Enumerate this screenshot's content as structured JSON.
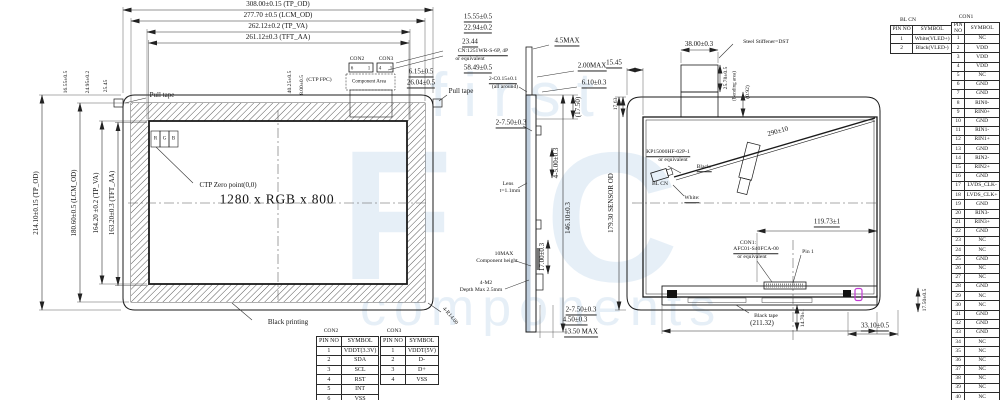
{
  "watermark": {
    "word_top": "first",
    "letter_f": "F",
    "letter_c": "C",
    "word_bottom": "components"
  },
  "front": {
    "top_dims": [
      "308.00±0.15 (TP_OD)",
      "277.70 ±0.5 (LCM_OD)",
      "262.12±0.2 (TP_VA)",
      "261.12±0.3 (TFT_AA)"
    ],
    "left_dims": [
      "214.10±0.15 (TP_OD)",
      "180.60±0.5 (LCM_OD)",
      "164.20 ±0.2 (TP_VA)",
      "163.20±0.3 (TFT_AA)"
    ],
    "left_top_dims": [
      "16.55±0.5",
      "24.95±0.2",
      "25.45"
    ],
    "right_dims": [
      "15.55±0.5",
      "22.94±0.2",
      "23.44",
      "58.49±0.5"
    ],
    "cn_note": [
      "CN:1251WR-S-6P, 4P",
      "or equivalent"
    ],
    "con2_label": "CON2",
    "con3_label": "CON3",
    "ctp_fpc": "(CTP FPC)",
    "component_area": "Component Area",
    "con_dims": [
      "6.15±0.5",
      "26.04±0.5",
      "40.25±0.5",
      "8.00±0.5"
    ],
    "pin_marks": [
      "6",
      "1",
      "4",
      "1"
    ],
    "pull_tape_left": "Pull tape",
    "pull_tape_right": "Pull tape",
    "rgb": [
      "R",
      "G",
      "B"
    ],
    "ctp_zero": "CTP Zero point(0,0)",
    "resolution": "1280 x RGB x 800",
    "black_printing": "Black printing",
    "corner_radius": "4-R14.00"
  },
  "side": {
    "dims": {
      "max45": "4.5MAX",
      "max200": "2.00MAX",
      "chamfer": "2-C0.15±0.1",
      "chamfer2": "(all around)",
      "d610": "6.10±0.3",
      "d1750": "(17.50)",
      "top750": "2-7.50±0.3",
      "d500": "4-5.00±0.3",
      "h146": "146.10±0.3",
      "d1700": "17.00±0.3",
      "bot750": "2-7.50±0.3",
      "d450": "4.50±0.3",
      "max1350": "13.50 MAX"
    },
    "lens": [
      "Lens",
      "t=1.1mm"
    ],
    "component": [
      "10MAX",
      "Component height"
    ],
    "screw": [
      "4-M2",
      "Depth Max 2.5mm"
    ]
  },
  "back": {
    "dims": {
      "d3800": "38.00±0.3",
      "d2578": "25.78±0.5",
      "bending": "(Bending area)",
      "d092": "(0.92)",
      "d1545": "15.45",
      "d1763": "17.63",
      "d290": "290±10",
      "d11973": "119.73±1",
      "d21132": "(211.32)",
      "d1470": "14.70±1",
      "d3310": "33.10±0.5",
      "d1750": "17.50±0.5",
      "sensor_od": "179.30 SENSOR OD"
    },
    "stiffener": "Steel Stiffener=DST",
    "bl_part": [
      "KP15000HF-02P-1",
      "or equivalent"
    ],
    "wire_black": "Black:",
    "wire_white": "White:",
    "bl_cn": "BL CN",
    "con1_note": [
      "CON1:",
      "AFC01-S40FCA-00",
      "or equivalent"
    ],
    "pin1": "Pin 1",
    "black_tape": "Black tape"
  },
  "tables": {
    "con2": {
      "title": "CON2",
      "headers": [
        "PIN NO",
        "SYMBOL"
      ],
      "rows": [
        [
          "1",
          "VDDT(3.3V)"
        ],
        [
          "2",
          "SDA"
        ],
        [
          "3",
          "SCL"
        ],
        [
          "4",
          "RST"
        ],
        [
          "5",
          "INT"
        ],
        [
          "6",
          "VSS"
        ]
      ]
    },
    "con3": {
      "title": "CON3",
      "headers": [
        "PIN NO",
        "SYMBOL"
      ],
      "rows": [
        [
          "1",
          "VDDT(5V)"
        ],
        [
          "2",
          "D-"
        ],
        [
          "3",
          "D+"
        ],
        [
          "4",
          "VSS"
        ]
      ]
    },
    "bl_cn": {
      "title": "BL CN",
      "headers": [
        "PIN NO",
        "SYMBOL"
      ],
      "rows": [
        [
          "1",
          "White(VLED+)"
        ],
        [
          "2",
          "Black(VLED-)"
        ]
      ]
    },
    "con1": {
      "title": "CON1",
      "headers": [
        "PIN NO",
        "SYMBOL"
      ],
      "rows": [
        [
          "1",
          "NC"
        ],
        [
          "2",
          "VDD"
        ],
        [
          "3",
          "VDD"
        ],
        [
          "4",
          "VDD"
        ],
        [
          "5",
          "NC"
        ],
        [
          "6",
          "GND"
        ],
        [
          "7",
          "GND"
        ],
        [
          "8",
          "RIN0-"
        ],
        [
          "9",
          "RIN0+"
        ],
        [
          "10",
          "GND"
        ],
        [
          "11",
          "RIN1-"
        ],
        [
          "12",
          "RIN1+"
        ],
        [
          "13",
          "GND"
        ],
        [
          "14",
          "RIN2-"
        ],
        [
          "15",
          "RIN2+"
        ],
        [
          "16",
          "GND"
        ],
        [
          "17",
          "LVDS_CLK-"
        ],
        [
          "18",
          "LVDS_CLK+"
        ],
        [
          "19",
          "GND"
        ],
        [
          "20",
          "RIN3-"
        ],
        [
          "21",
          "RIN3+"
        ],
        [
          "22",
          "GND"
        ],
        [
          "23",
          "NC"
        ],
        [
          "24",
          "NC"
        ],
        [
          "25",
          "GND"
        ],
        [
          "26",
          "NC"
        ],
        [
          "27",
          "NC"
        ],
        [
          "28",
          "GND"
        ],
        [
          "29",
          "NC"
        ],
        [
          "30",
          "NC"
        ],
        [
          "31",
          "GND"
        ],
        [
          "32",
          "GND"
        ],
        [
          "33",
          "GND"
        ],
        [
          "34",
          "NC"
        ],
        [
          "35",
          "NC"
        ],
        [
          "36",
          "NC"
        ],
        [
          "37",
          "NC"
        ],
        [
          "38",
          "NC"
        ],
        [
          "39",
          "NC"
        ],
        [
          "40",
          "NC"
        ]
      ]
    }
  },
  "colors": {
    "line": "#1b1b1b",
    "watermark": "#cfe0f0",
    "magenta_mark": "#c23bd4",
    "lens_tint": "#bfcedd"
  }
}
